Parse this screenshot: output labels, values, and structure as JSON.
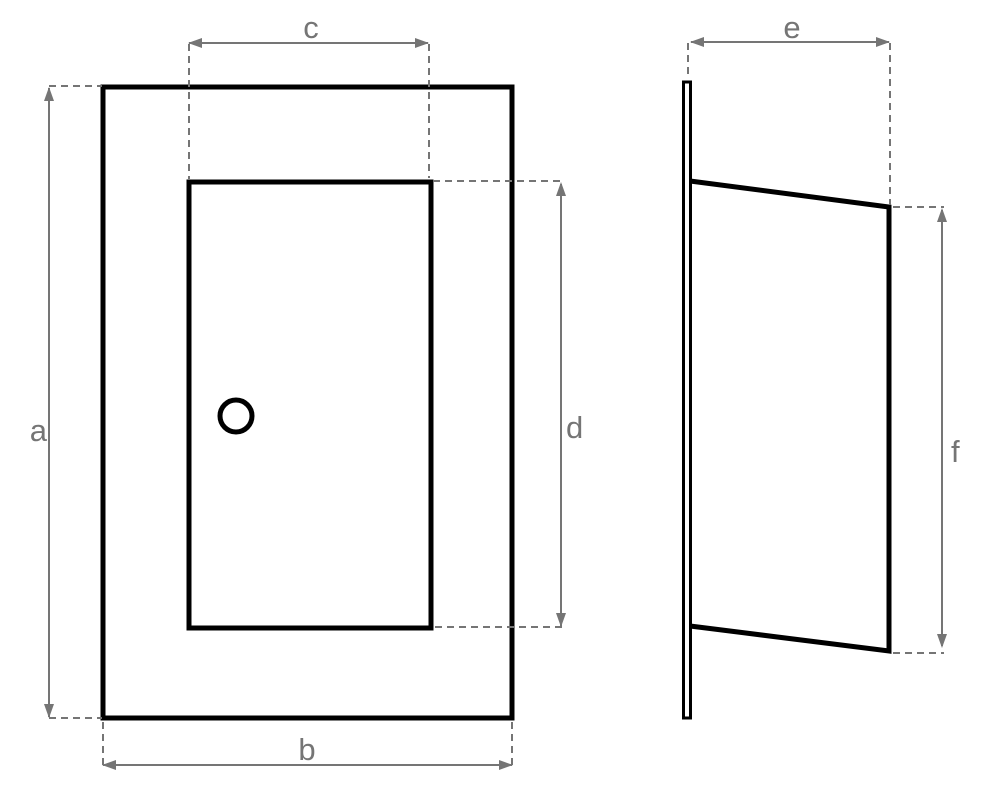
{
  "colors": {
    "shape": "#000000",
    "dimension": "#757575",
    "background": "#ffffff"
  },
  "dimensions": {
    "a": {
      "label": "a"
    },
    "b": {
      "label": "b"
    },
    "c": {
      "label": "c"
    },
    "d": {
      "label": "d"
    },
    "e": {
      "label": "e"
    },
    "f": {
      "label": "f"
    }
  }
}
